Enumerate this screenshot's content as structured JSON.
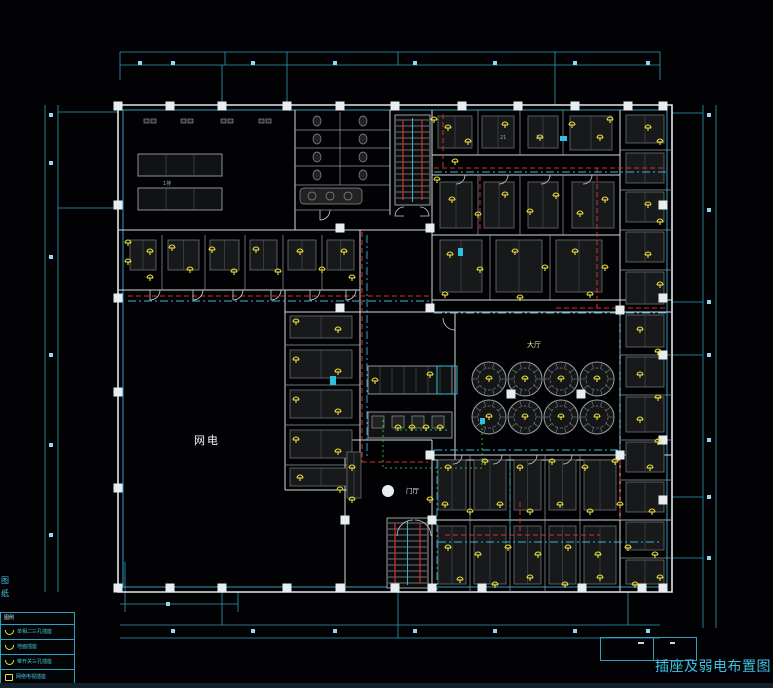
{
  "title_block": {
    "title": "插座及弱电布置图"
  },
  "legend": {
    "header": "图例",
    "rows": [
      {
        "label": "单相二三孔插座"
      },
      {
        "label": "地面插座"
      },
      {
        "label": "带开关三孔插座"
      },
      {
        "label": "网络电视插座"
      }
    ]
  },
  "labels": {
    "dining_hall": "大厅",
    "lobby": "门厅",
    "left_room": "网电",
    "row_label": "1排",
    "room_no_1": "21",
    "room_no_2": "23",
    "axis_side": "图纸"
  },
  "colors": {
    "cyan": "#2f9fbe",
    "wall": "#d7e0e4",
    "yellow": "#efe13e",
    "red": "#d83030",
    "green": "#2fae3f"
  },
  "plan": {
    "ticks": {
      "top": {
        "y": 63,
        "xs": [
          140,
          173,
          253,
          335,
          415,
          495,
          575,
          648
        ]
      },
      "bottom": {
        "y": 631,
        "xs": [
          173,
          253,
          335,
          415,
          495,
          575,
          648
        ]
      },
      "left": {
        "x": 51,
        "ys": [
          115,
          163,
          257,
          355,
          445,
          535
        ]
      },
      "right": {
        "x": 709,
        "ys": [
          115,
          210,
          302,
          355,
          440,
          497,
          558
        ]
      },
      "extra": [
        [
          168,
          604
        ]
      ]
    },
    "columns": [
      [
        118,
        106
      ],
      [
        170,
        106
      ],
      [
        222,
        106
      ],
      [
        287,
        106
      ],
      [
        340,
        106
      ],
      [
        395,
        106
      ],
      [
        462,
        106
      ],
      [
        518,
        106
      ],
      [
        575,
        106
      ],
      [
        628,
        106
      ],
      [
        663,
        106
      ],
      [
        118,
        205
      ],
      [
        118,
        298
      ],
      [
        118,
        392
      ],
      [
        118,
        488
      ],
      [
        118,
        588
      ],
      [
        170,
        588
      ],
      [
        222,
        588
      ],
      [
        287,
        588
      ],
      [
        340,
        588
      ],
      [
        395,
        588
      ],
      [
        432,
        588
      ],
      [
        482,
        588
      ],
      [
        582,
        588
      ],
      [
        642,
        588
      ],
      [
        663,
        588
      ],
      [
        663,
        205
      ],
      [
        663,
        298
      ],
      [
        663,
        355
      ],
      [
        663,
        440
      ],
      [
        663,
        500
      ],
      [
        340,
        228
      ],
      [
        430,
        228
      ],
      [
        340,
        308
      ],
      [
        430,
        308
      ],
      [
        511,
        394
      ],
      [
        581,
        394
      ],
      [
        430,
        455
      ],
      [
        620,
        310
      ],
      [
        620,
        455
      ],
      [
        345,
        520
      ],
      [
        432,
        520
      ]
    ],
    "furniture": [
      [
        130,
        240,
        26,
        30
      ],
      [
        168,
        240,
        31,
        30
      ],
      [
        210,
        240,
        29,
        30
      ],
      [
        250,
        240,
        27,
        30
      ],
      [
        288,
        240,
        28,
        30
      ],
      [
        327,
        240,
        27,
        30
      ],
      [
        290,
        316,
        62,
        22
      ],
      [
        290,
        350,
        62,
        28
      ],
      [
        290,
        390,
        62,
        28
      ],
      [
        290,
        430,
        62,
        28
      ],
      [
        290,
        468,
        62,
        18
      ],
      [
        438,
        116,
        34,
        32
      ],
      [
        482,
        116,
        32,
        32
      ],
      [
        528,
        116,
        30,
        32
      ],
      [
        570,
        116,
        42,
        34
      ],
      [
        440,
        182,
        32,
        46
      ],
      [
        484,
        182,
        30,
        46
      ],
      [
        528,
        182,
        30,
        46
      ],
      [
        572,
        182,
        42,
        46
      ],
      [
        440,
        240,
        42,
        52
      ],
      [
        496,
        240,
        46,
        52
      ],
      [
        556,
        240,
        46,
        52
      ],
      [
        626,
        115,
        38,
        28
      ],
      [
        626,
        153,
        38,
        30
      ],
      [
        626,
        192,
        38,
        30
      ],
      [
        626,
        232,
        38,
        30
      ],
      [
        626,
        272,
        38,
        32
      ],
      [
        626,
        315,
        38,
        32
      ],
      [
        626,
        357,
        38,
        30
      ],
      [
        626,
        397,
        38,
        35
      ],
      [
        626,
        442,
        38,
        30
      ],
      [
        626,
        482,
        38,
        30
      ],
      [
        626,
        522,
        38,
        28
      ],
      [
        626,
        560,
        38,
        24
      ],
      [
        438,
        460,
        28,
        50
      ],
      [
        474,
        460,
        32,
        50
      ],
      [
        514,
        460,
        27,
        50
      ],
      [
        549,
        460,
        27,
        50
      ],
      [
        584,
        460,
        32,
        50
      ],
      [
        438,
        526,
        28,
        58
      ],
      [
        474,
        526,
        32,
        58
      ],
      [
        514,
        526,
        27,
        58
      ],
      [
        549,
        526,
        27,
        58
      ],
      [
        584,
        526,
        32,
        58
      ],
      [
        347,
        452,
        14,
        46
      ]
    ],
    "wall_fixtures": [
      [
        150,
        121
      ],
      [
        187,
        121
      ],
      [
        227,
        121
      ],
      [
        265,
        121
      ]
    ],
    "round_tables": {
      "cx": [
        489,
        525,
        561,
        597
      ],
      "cy": [
        379,
        417
      ],
      "r": 17
    },
    "rect_tables": {
      "x": 138,
      "w": 84,
      "h": 22,
      "cols": 3,
      "rows": [
        154,
        188
      ]
    },
    "stairs": [
      {
        "x": 395,
        "y": 115,
        "w": 35,
        "h": 90
      },
      {
        "x": 387,
        "y": 518,
        "w": 41,
        "h": 70
      }
    ],
    "wiring_red": [
      "M128,296 H430",
      "M362,232 V296",
      "M434,168 H668",
      "M443,114 V168",
      "M597,168 V308",
      "M556,308 H668",
      "M362,300 V462",
      "M362,462 H428",
      "M480,176 V232",
      "M445,535 H600",
      "M520,502 V535",
      "M620,460 V520"
    ],
    "wiring_cyan": [
      "M128,301 H430",
      "M434,172 H668",
      "M434,313 H668",
      "M367,235 V458",
      "M620,316 V455",
      "M434,450 H618",
      "M438,542 H660",
      "M510,462 V540",
      "M437,460 V590"
    ],
    "wiring_green": [
      "M383,420 V468 H482 V422",
      "M395,430 H450"
    ],
    "door_arcs": [
      "M160,290 A10,10 0 0 1 150,300 L150,290",
      "M203,290 A10,10 0 0 1 193,300 L193,290",
      "M243,290 A10,10 0 0 1 233,300 L233,290",
      "M281,290 A10,10 0 0 1 271,300 L271,290",
      "M320,290 A10,10 0 0 1 310,300 L310,290",
      "M356,290 A10,10 0 0 1 346,300 L346,290",
      "M330,210 A10,10 0 0 1 320,220 L320,210",
      "M404,207 A9,9 0 0 0 395,216 L404,216",
      "M420,207 A9,9 0 0 1 429,216 L420,216",
      "M397,536 A16,16 0 0 1 413,520",
      "M431,536 A16,16 0 0 0 415,520",
      "M465,175 A9,9 0 0 1 456,184",
      "M508,175 A9,9 0 0 1 499,184",
      "M550,175 A9,9 0 0 1 541,184",
      "M592,175 A9,9 0 0 1 583,184",
      "M462,455 A9,9 0 0 1 453,464",
      "M502,455 A9,9 0 0 1 493,464",
      "M537,455 A9,9 0 0 1 528,464",
      "M572,455 A9,9 0 0 1 563,464",
      "M455,330 A12,12 0 0 1 443,318"
    ],
    "highlights": [
      [
        330,
        376,
        6,
        9
      ],
      [
        458,
        248,
        5,
        8
      ],
      [
        560,
        136,
        7,
        5
      ],
      [
        480,
        418,
        5,
        6
      ]
    ],
    "sockets": [
      [
        128,
        243
      ],
      [
        128,
        262
      ],
      [
        150,
        252
      ],
      [
        150,
        278
      ],
      [
        172,
        248
      ],
      [
        190,
        270
      ],
      [
        212,
        250
      ],
      [
        234,
        272
      ],
      [
        256,
        250
      ],
      [
        278,
        272
      ],
      [
        300,
        252
      ],
      [
        322,
        270
      ],
      [
        344,
        252
      ],
      [
        352,
        278
      ],
      [
        296,
        322
      ],
      [
        338,
        330
      ],
      [
        296,
        360
      ],
      [
        338,
        372
      ],
      [
        296,
        400
      ],
      [
        338,
        412
      ],
      [
        296,
        440
      ],
      [
        338,
        452
      ],
      [
        300,
        478
      ],
      [
        340,
        490
      ],
      [
        448,
        128
      ],
      [
        468,
        142
      ],
      [
        505,
        125
      ],
      [
        540,
        138
      ],
      [
        572,
        125
      ],
      [
        600,
        138
      ],
      [
        610,
        120
      ],
      [
        648,
        128
      ],
      [
        660,
        142
      ],
      [
        434,
        120
      ],
      [
        437,
        180
      ],
      [
        455,
        162
      ],
      [
        452,
        200
      ],
      [
        478,
        215
      ],
      [
        505,
        195
      ],
      [
        530,
        212
      ],
      [
        556,
        196
      ],
      [
        580,
        214
      ],
      [
        605,
        200
      ],
      [
        648,
        205
      ],
      [
        660,
        222
      ],
      [
        450,
        255
      ],
      [
        480,
        270
      ],
      [
        515,
        252
      ],
      [
        545,
        268
      ],
      [
        575,
        252
      ],
      [
        605,
        268
      ],
      [
        648,
        255
      ],
      [
        660,
        285
      ],
      [
        445,
        295
      ],
      [
        520,
        298
      ],
      [
        590,
        295
      ],
      [
        640,
        330
      ],
      [
        658,
        352
      ],
      [
        640,
        375
      ],
      [
        658,
        398
      ],
      [
        640,
        420
      ],
      [
        658,
        442
      ],
      [
        489,
        379
      ],
      [
        525,
        379
      ],
      [
        561,
        379
      ],
      [
        597,
        379
      ],
      [
        489,
        417
      ],
      [
        525,
        417
      ],
      [
        561,
        417
      ],
      [
        597,
        417
      ],
      [
        398,
        428
      ],
      [
        412,
        428
      ],
      [
        426,
        428
      ],
      [
        440,
        428
      ],
      [
        375,
        381
      ],
      [
        430,
        375
      ],
      [
        352,
        468
      ],
      [
        352,
        500
      ],
      [
        430,
        500
      ],
      [
        448,
        468
      ],
      [
        485,
        462
      ],
      [
        520,
        468
      ],
      [
        552,
        462
      ],
      [
        585,
        468
      ],
      [
        615,
        462
      ],
      [
        650,
        468
      ],
      [
        445,
        505
      ],
      [
        470,
        512
      ],
      [
        500,
        505
      ],
      [
        530,
        512
      ],
      [
        560,
        505
      ],
      [
        590,
        512
      ],
      [
        620,
        505
      ],
      [
        652,
        512
      ],
      [
        448,
        548
      ],
      [
        478,
        555
      ],
      [
        508,
        548
      ],
      [
        538,
        555
      ],
      [
        568,
        548
      ],
      [
        598,
        555
      ],
      [
        628,
        548
      ],
      [
        655,
        555
      ],
      [
        460,
        580
      ],
      [
        495,
        585
      ],
      [
        530,
        578
      ],
      [
        565,
        585
      ],
      [
        600,
        578
      ],
      [
        635,
        585
      ],
      [
        660,
        578
      ]
    ]
  }
}
